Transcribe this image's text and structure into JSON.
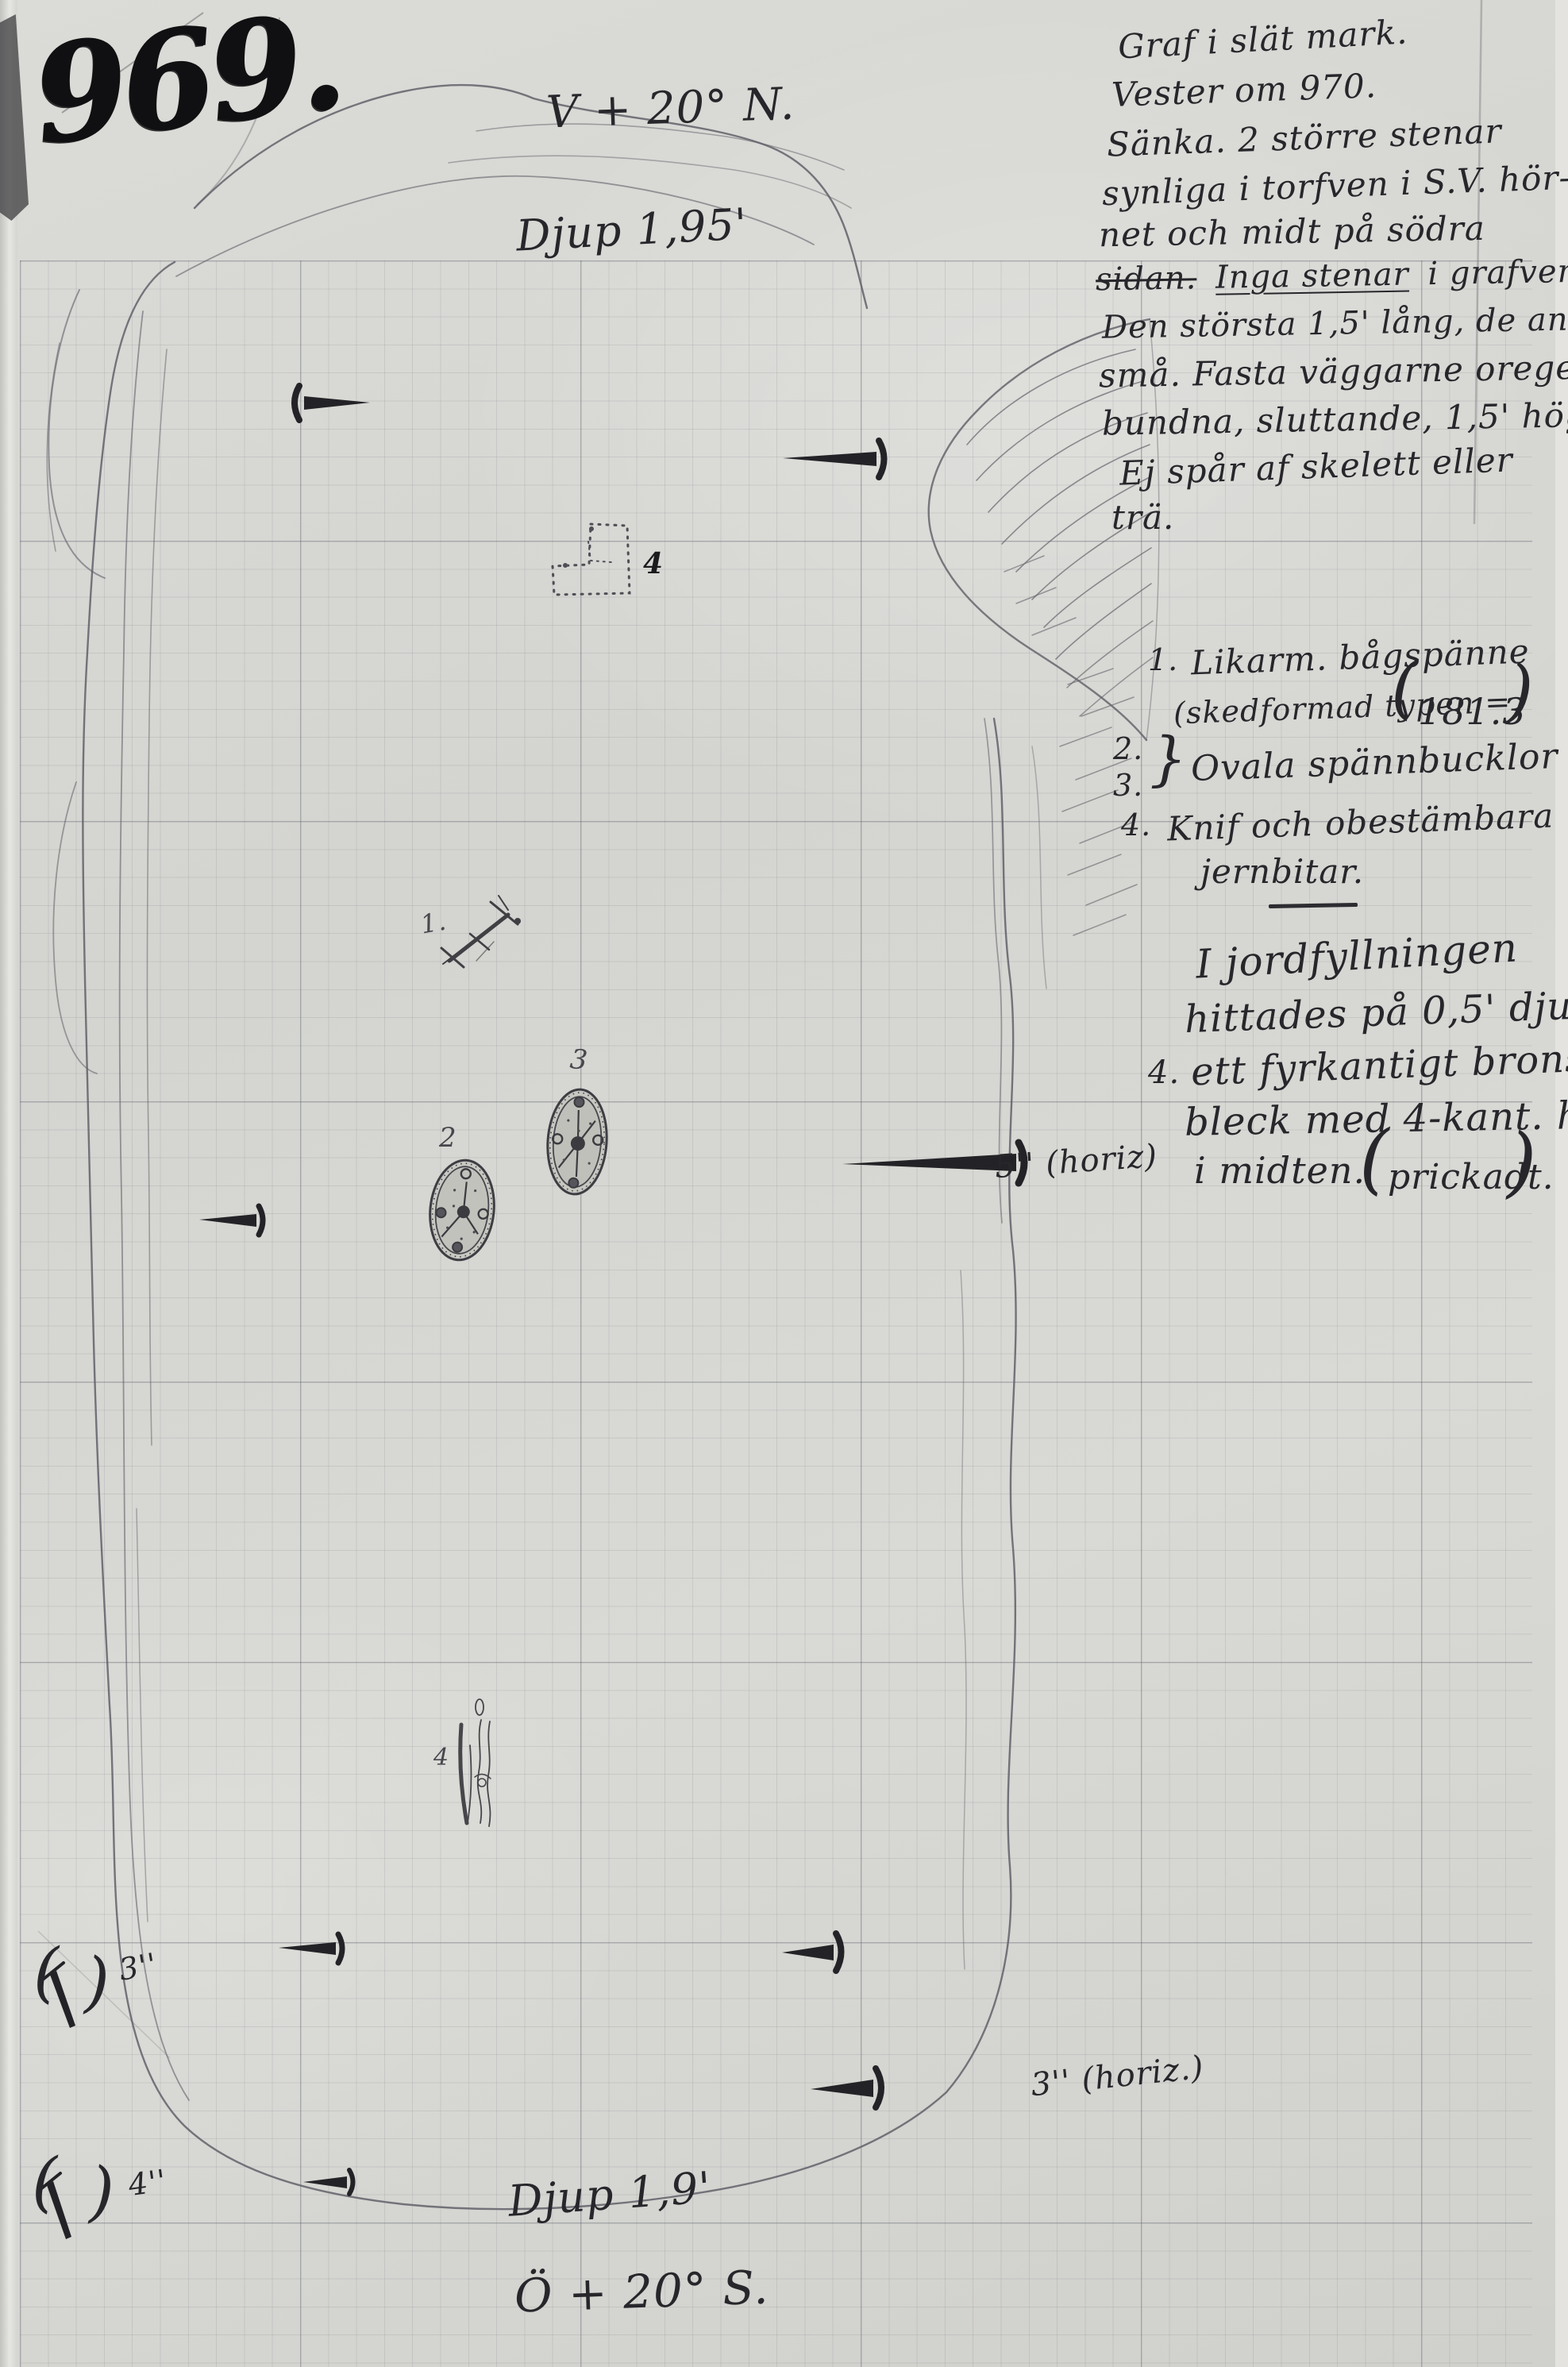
{
  "document": {
    "page_number": "969.",
    "plan": {
      "orientation_top": "V + 20° N.",
      "depth_top": "Djup 1,95'",
      "depth_bottom": "Djup 1,9'",
      "orientation_bottom": "Ö + 20° S.",
      "nail_note_middle": "5'' (horiz)",
      "nail_note_bottom": "3'' (horiz.)",
      "corner_marker_1": {
        "open": "(",
        "close": ")",
        "size": "3''"
      },
      "corner_marker_2": {
        "open": "(",
        "close": ")",
        "size": "4''"
      },
      "find_labels": {
        "brooch": "1.",
        "oval_left": "2",
        "oval_right": "3",
        "bronze_plate": "4",
        "knife": "4"
      }
    },
    "notes": {
      "description": {
        "l1": "Graf i slät mark.",
        "l2": "Vester om 970.",
        "l3": "Sänka. 2 större stenar",
        "l4": "synliga i torfven i S.V. hör-",
        "l5": "net och midt på södra",
        "l6_struck": "sidan.",
        "l6_underlined": "Inga stenar",
        "l6_rest": "i grafven;",
        "l7": "Den största 1,5' lång, de andra",
        "l8": "små. Fasta väggarne oregel-",
        "l9": "bundna, sluttande, 1,5' höga.",
        "l10": "Ej spår af skelett eller",
        "l11": "trä."
      },
      "finds": {
        "item1_no": "1.",
        "item1_text": "Likarm. bågspänne",
        "item1_sub": "(skedformad typen =",
        "item1_ref_open": "(",
        "item1_ref": "181.3",
        "item1_ref_close": ")",
        "item2_no": "2.",
        "item3_no": "3.",
        "brace": "}",
        "item23_text": "Ovala spännbucklor",
        "item4_no": "4.",
        "item4_text": "Knif och obestämbara",
        "item4_text2": "jernbitar."
      },
      "burial_note": {
        "l1": "I jordfyllningen",
        "l2": "hittades på 0,5' djup",
        "l3_no": "4.",
        "l3": "ett fyrkantigt brons=",
        "l4": "bleck med 4-kant. hål",
        "l5": "i midten.",
        "paren_open": "(",
        "prickadt": "prickadt.",
        "paren_close": ")"
      }
    }
  }
}
